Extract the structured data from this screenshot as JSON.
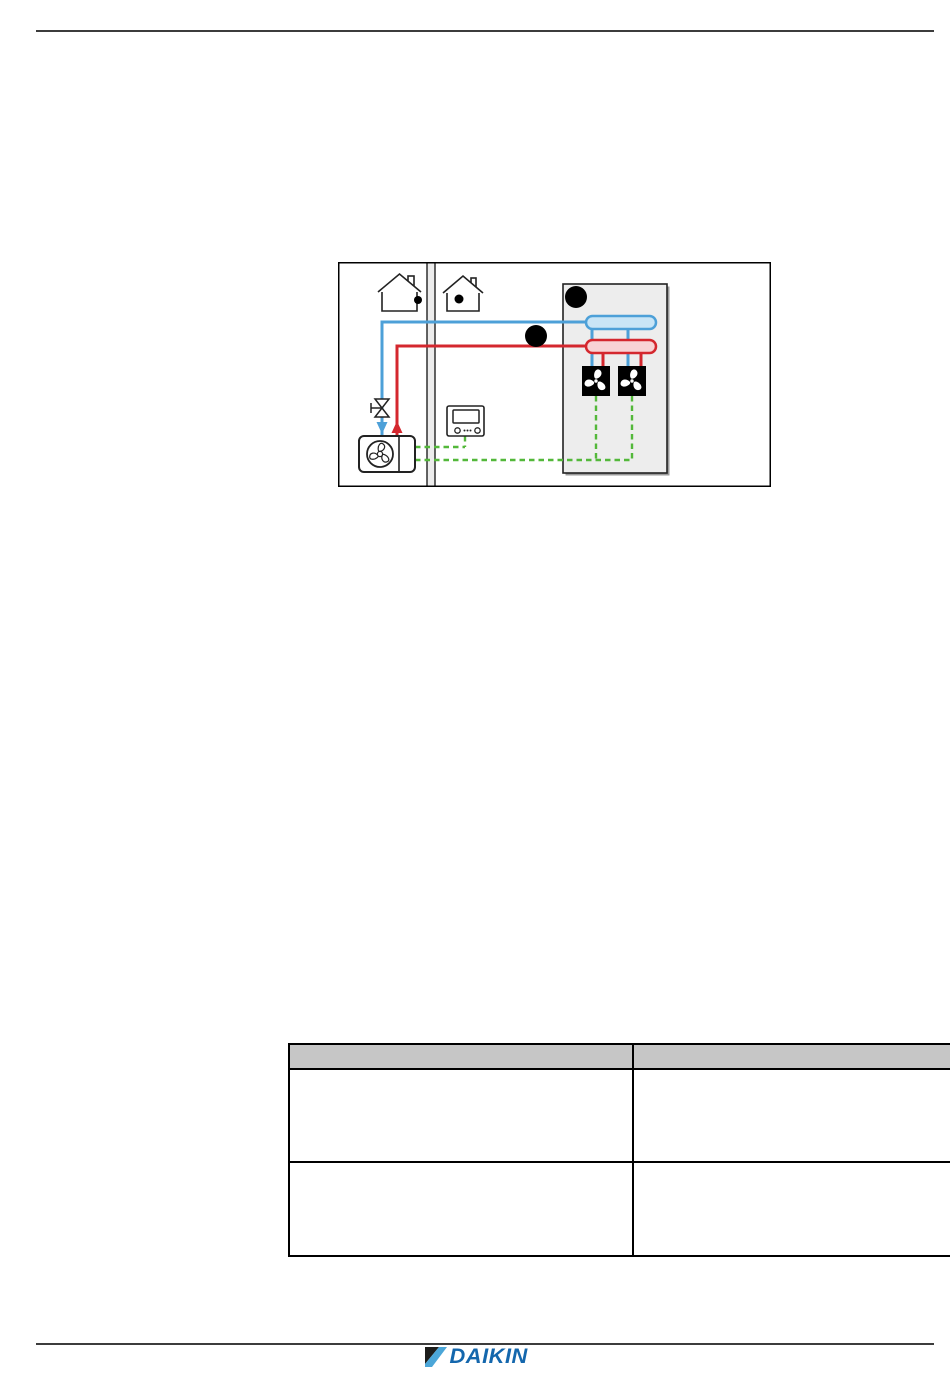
{
  "page": {
    "kind": "installer-manual-page",
    "background": "#ffffff"
  },
  "colors": {
    "rule": "#3c3c3c",
    "line-dark": "#222222",
    "pipe-blue": "#4da0d8",
    "pipe-blue-fill": "#c9e5f6",
    "pipe-red": "#d4272e",
    "pipe-red-fill": "#f8d3d5",
    "wire-green": "#53b83a",
    "box-fill": "#ededed",
    "box-shadow": "#9a9a9a",
    "wall-fill": "#ececec",
    "table-header": "#c6c6c6",
    "logo-blue": "#1467ad",
    "logo-dark": "#1d1d1b",
    "logo-light": "#4ba6d8"
  },
  "diagram": {
    "description": "System layout: outdoor unit with shut-off valve and room controller connected through a wall to an indoor zone box with supply/return headers feeding two fan coil units; blue = water out, red = water return, green dashed = control wiring",
    "icons": [
      "house-outdoor-icon",
      "house-indoor-icon",
      "partition-wall",
      "outdoor-unit-icon",
      "fan-icon",
      "shutoff-valve-icon",
      "room-controller-icon",
      "connector-node-a",
      "connector-node-b",
      "supply-header",
      "return-header",
      "fan-coil-unit-icon"
    ]
  },
  "table": {
    "columns": [
      "",
      ""
    ],
    "rows": [
      [
        "",
        ""
      ],
      [
        "",
        ""
      ]
    ]
  },
  "footer": {
    "logo_text": "DAIKIN"
  }
}
